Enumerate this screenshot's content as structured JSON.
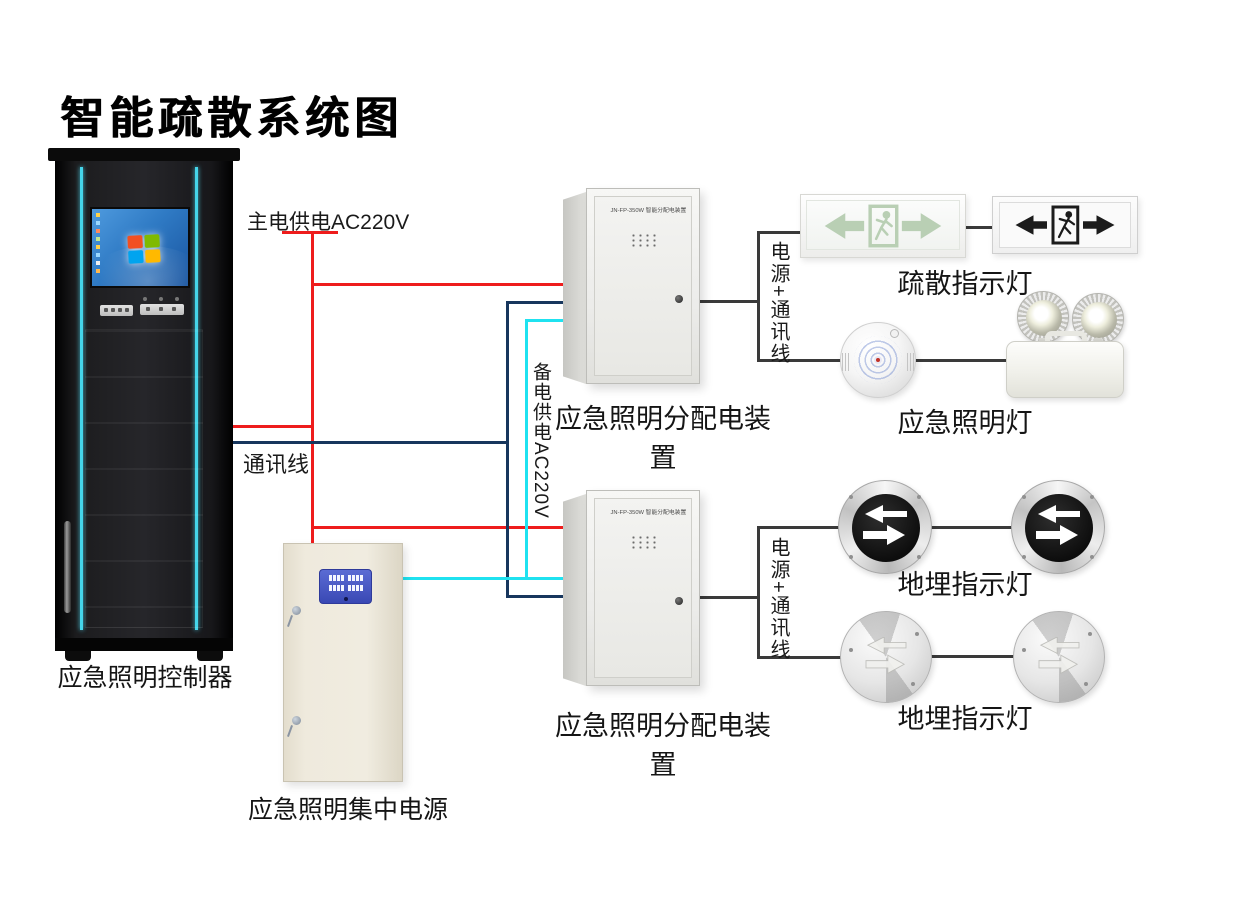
{
  "title": "智能疏散系统图",
  "colors": {
    "main_power_wire": "#ee1c1c",
    "communication_wire": "#17365d",
    "backup_power_wire": "#1fe2f0",
    "connector_wire": "#3a3a3a",
    "cabinet_accent": "#45d5ea"
  },
  "wire_labels": {
    "main_power": "主电供电AC220V",
    "communication": "通讯线",
    "backup_power": "备电供电AC220V",
    "power_comm_1": "电源+通讯线",
    "power_comm_2": "电源+通讯线"
  },
  "devices": {
    "controller": {
      "label": "应急照明控制器"
    },
    "central_power": {
      "label": "应急照明集中电源"
    },
    "dist_box_1": {
      "label": "应急照明分配电装置",
      "model": "JN-FP-350W 智能分配电装置"
    },
    "dist_box_2": {
      "label": "应急照明分配电装置",
      "model": "JN-FP-350W 智能分配电装置"
    },
    "exit_sign_group": {
      "label": "疏散指示灯"
    },
    "emergency_light_group": {
      "label": "应急照明灯"
    },
    "ground_light_group_1": {
      "label": "地埋指示灯"
    },
    "ground_light_group_2": {
      "label": "地埋指示灯"
    }
  }
}
